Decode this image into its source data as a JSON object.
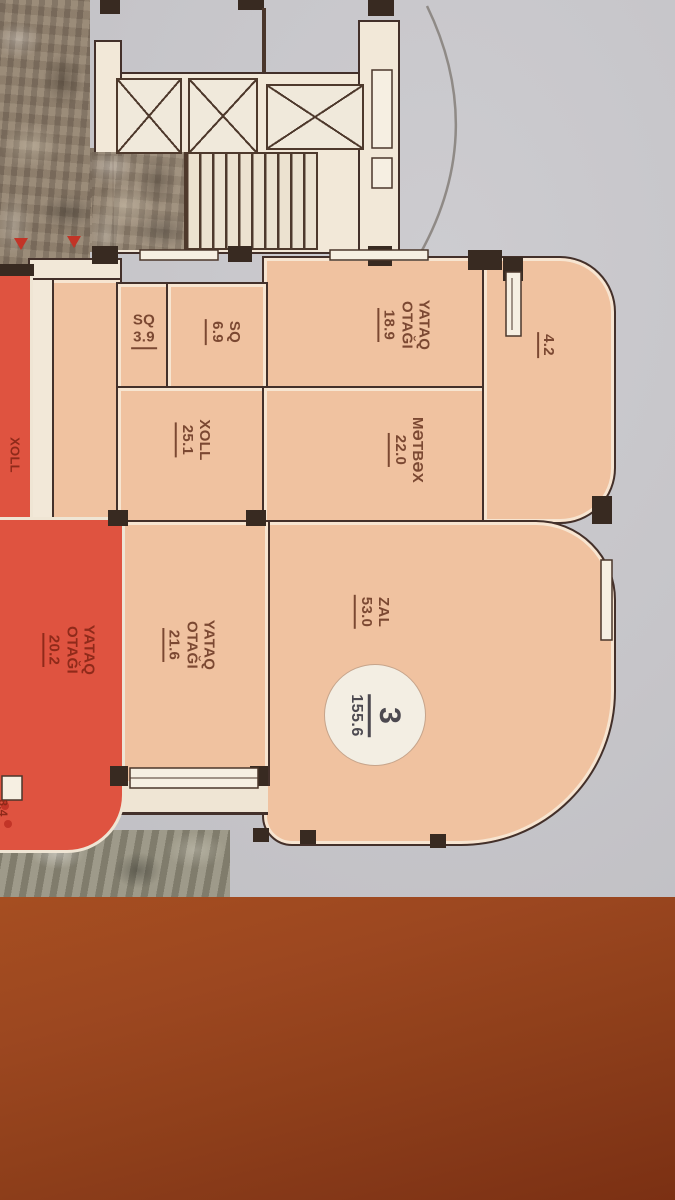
{
  "plan": {
    "unit_badge": {
      "number": "3",
      "total_area": "155.6"
    },
    "rooms": [
      {
        "name": "YATAQ OTAĞI",
        "area": "18.9"
      },
      {
        "name": "SQ",
        "area": "6.9"
      },
      {
        "name": "SQ",
        "area": "3.9"
      },
      {
        "name": "XOLL",
        "area": "25.1"
      },
      {
        "name": "MƏTBƏX",
        "area": "22.0"
      },
      {
        "name": "ZAL",
        "area": "53.0"
      },
      {
        "name": "YATAQ OTAĞI",
        "area": "21.6"
      }
    ],
    "balcony_area": "4.2",
    "adjacent_unit": {
      "hall_label": "XOLL",
      "bedroom": {
        "name": "YATAQ OTAĞI",
        "area": "20.2"
      },
      "edge_area": "8.4"
    },
    "colors": {
      "sheet_gray": "#c6c5c9",
      "room_fill": "#f0c2a0",
      "adjacent_unit_fill": "#df5340",
      "wall": "#43302a",
      "label_text": "#7c4a34",
      "table_wood": "#9c4a1e"
    }
  }
}
